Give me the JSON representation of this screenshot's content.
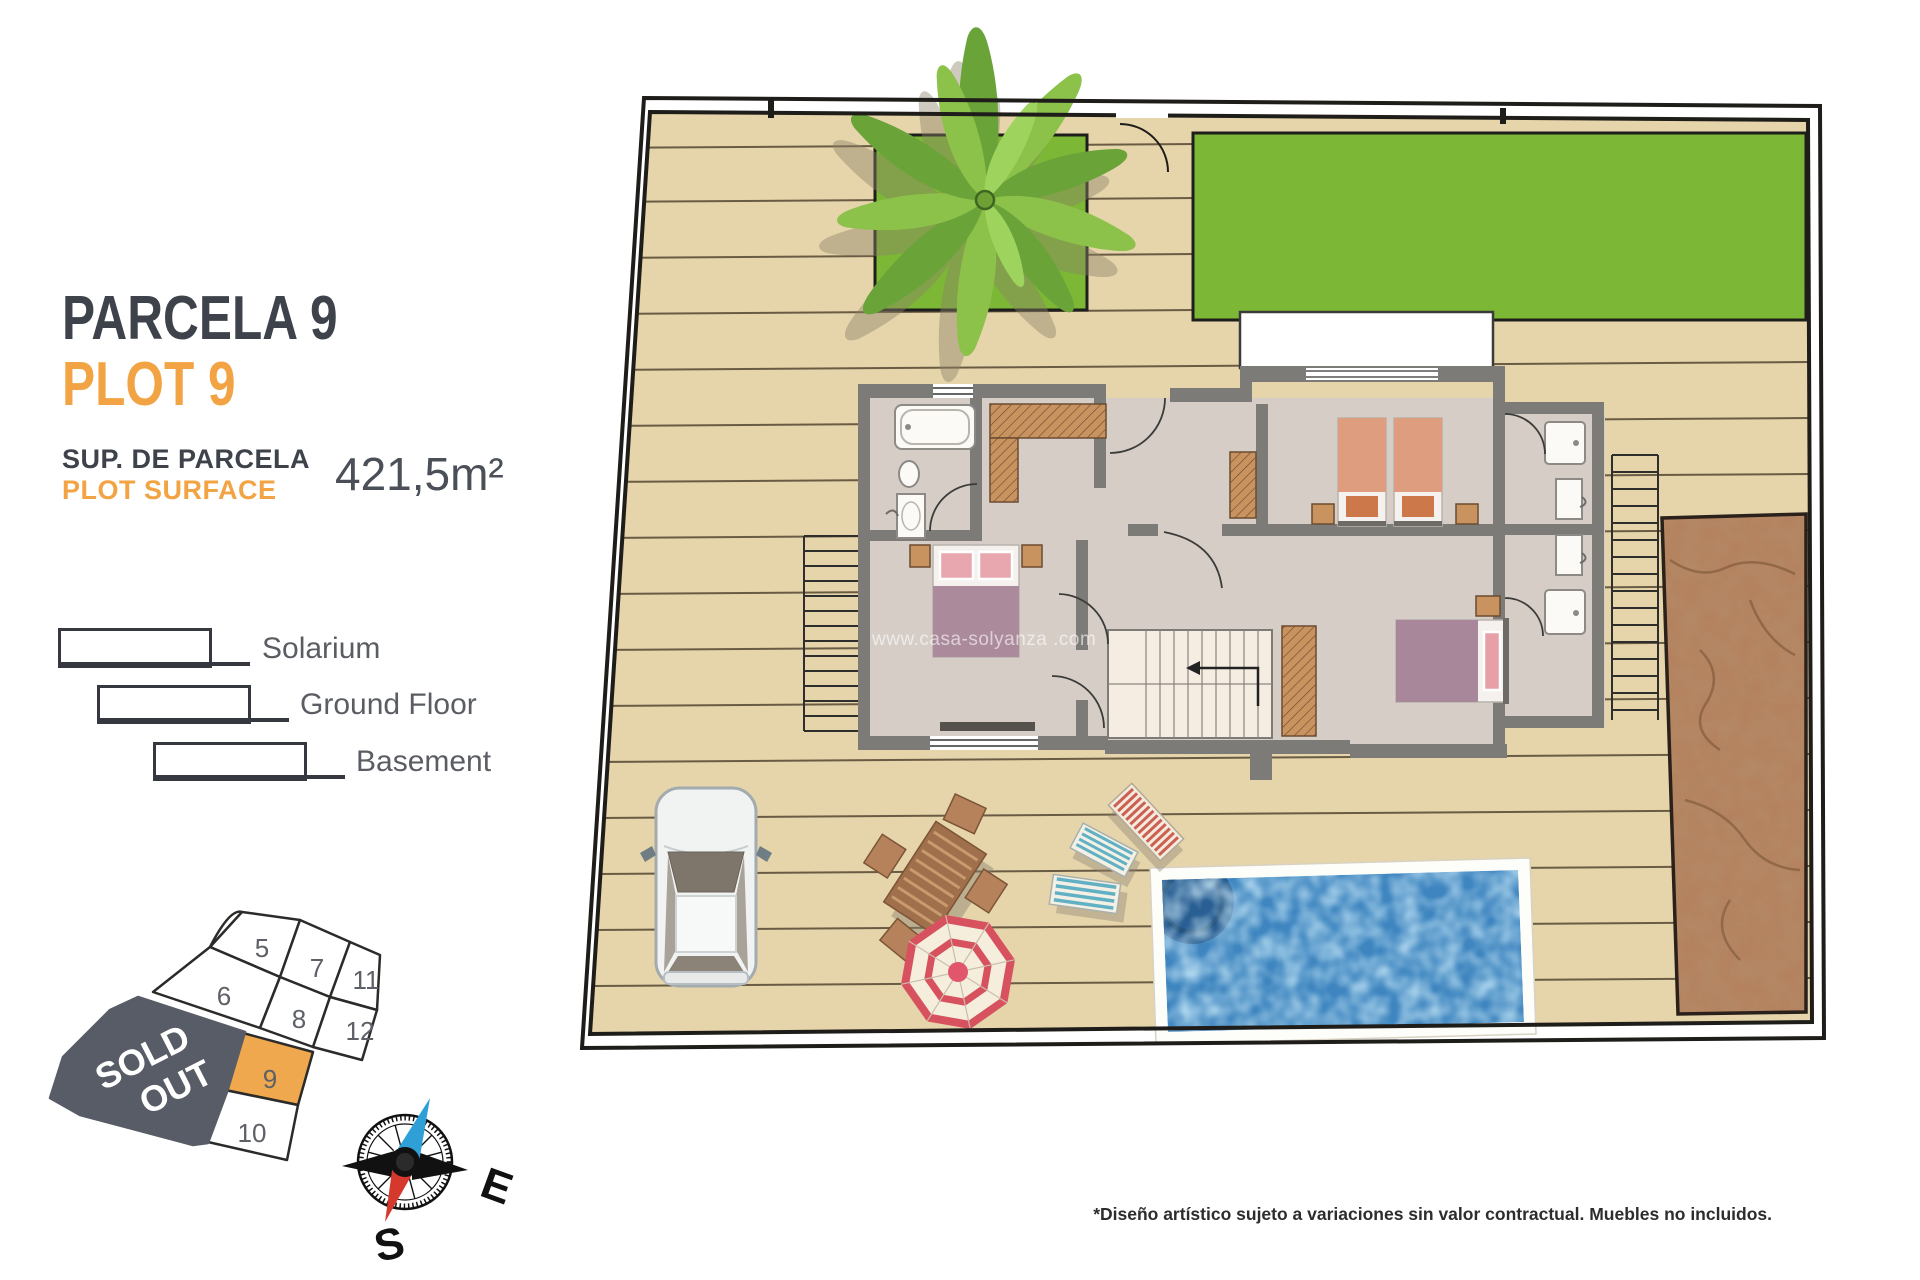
{
  "info": {
    "title_primary": "PARCELA 9",
    "title_secondary": "PLOT 9",
    "surface_label_primary": "SUP. DE PARCELA",
    "surface_label_secondary": "PLOT SURFACE",
    "surface_value": "421,5m²"
  },
  "legend": {
    "items": [
      {
        "label": "Solarium"
      },
      {
        "label": "Ground Floor"
      },
      {
        "label": "Basement"
      }
    ]
  },
  "minimap": {
    "plots": [
      {
        "number": "5"
      },
      {
        "number": "7"
      },
      {
        "number": "11"
      },
      {
        "number": "6"
      },
      {
        "number": "8"
      },
      {
        "number": "12"
      },
      {
        "number": "9"
      },
      {
        "number": "10"
      }
    ],
    "highlighted_plot": "9",
    "sold_out": {
      "line1": "SOLD",
      "line2": "OUT"
    }
  },
  "compass": {
    "east": "E",
    "south": "S"
  },
  "plan": {
    "watermark": "www.casa-solyanza .com"
  },
  "footer": {
    "disclaimer": "*Diseño artístico sujeto a variaciones sin valor contractual. Muebles no incluidos."
  },
  "colors": {
    "accent_orange": "#F2A444",
    "dark_text": "#3E434B",
    "plot_highlight": "#F0A84E",
    "sold_out_gray": "#575C66",
    "lawn_green": "#7CB735",
    "deck_beige": "#E6D5AA",
    "pool_blue": "#3F86C0",
    "dirt_brown": "#B5825F",
    "wall_gray": "#7D7B78"
  }
}
